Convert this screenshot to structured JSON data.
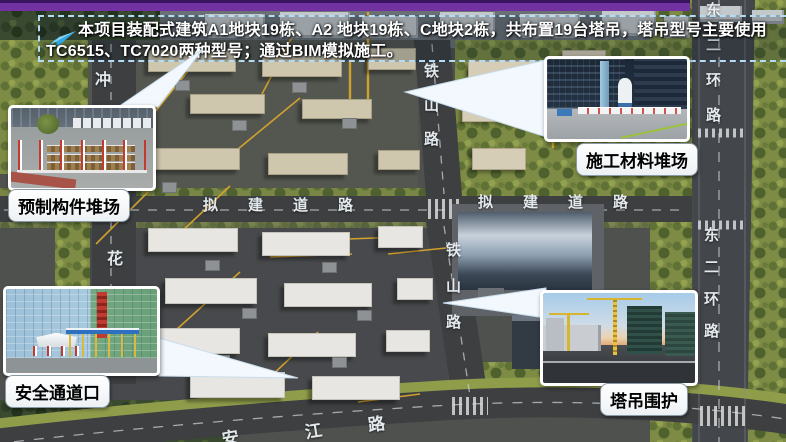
{
  "banner": {
    "icon": "paper-plane-arrow",
    "line1": "本项目装配式建筑A1地块19栋、A2 地块19栋、C地块2栋，共布置19台塔吊，塔吊型号主要使用",
    "line2": "TC6515、TC7020两种型号；通过BIM模拟施工。"
  },
  "callouts": {
    "precast": {
      "label": "预制构件堆场"
    },
    "material": {
      "label": "施工材料堆场"
    },
    "safety": {
      "label": "安全通道口"
    },
    "crane": {
      "label": "塔吊围护"
    }
  },
  "road_labels": {
    "tieshan_upper": [
      "铁",
      "山",
      "路"
    ],
    "tieshan_lower": [
      "铁",
      "山",
      "路"
    ],
    "nijian_west": [
      "拟",
      "建",
      "道",
      "路"
    ],
    "nijian_east": [
      "拟",
      "建",
      "道",
      "路"
    ],
    "dongerhuan_upper": [
      "东",
      "二",
      "环",
      "路"
    ],
    "dongerhuan_lower": [
      "东",
      "二",
      "环",
      "路"
    ],
    "bottom_road": [
      "安",
      "江",
      "路"
    ],
    "left_road_top": "冲",
    "left_road_bottom": "花"
  },
  "colors": {
    "accent_bar": "#7232a2",
    "banner_border": "#b5dcf5",
    "arrow_icon": "#2fa8e8",
    "crane_lines": "#d8a62c",
    "callout_bg": "#ffffff"
  }
}
